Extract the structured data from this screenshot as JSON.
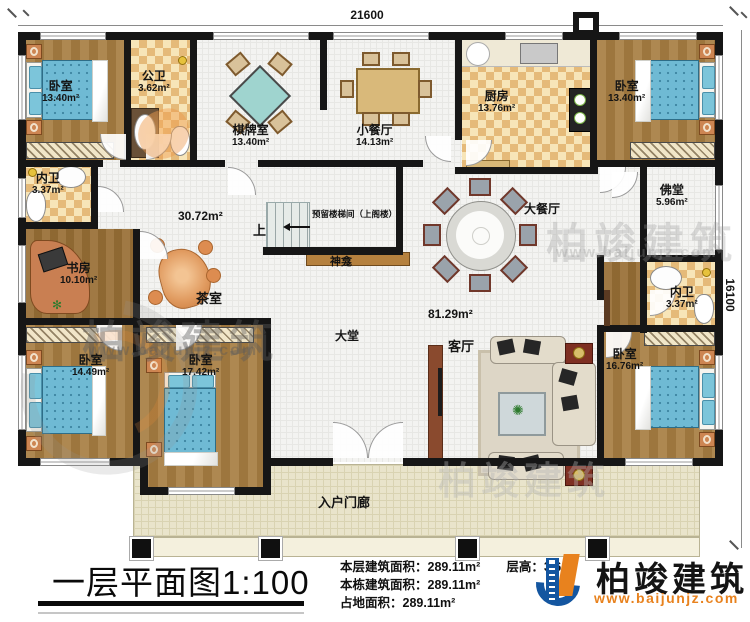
{
  "plan": {
    "dim_top": "21600",
    "dim_right": "16100",
    "stair_note": "预留楼梯间（上阁楼）",
    "stair_up": "上",
    "shrine": "神龛",
    "rooms": {
      "bedroom_tl": {
        "name": "卧室",
        "area": "13.40m²"
      },
      "public_bath": {
        "name": "公卫",
        "area": "3.62m²"
      },
      "chess_room": {
        "name": "棋牌室",
        "area": "13.40m²"
      },
      "small_dining": {
        "name": "小餐厅",
        "area": "14.13m²"
      },
      "kitchen": {
        "name": "厨房",
        "area": "13.76m²"
      },
      "bedroom_tr": {
        "name": "卧室",
        "area": "13.40m²"
      },
      "inner_bath_left": {
        "name": "内卫",
        "area": "3.37m²"
      },
      "study": {
        "name": "书房",
        "area": "10.10m²"
      },
      "tea_room": {
        "name": "茶室",
        "area": "30.72m²"
      },
      "grand_dining": {
        "name": "大餐厅"
      },
      "buddha_hall": {
        "name": "佛堂",
        "area": "5.96m²"
      },
      "inner_bath_right": {
        "name": "内卫",
        "area": "3.37m²"
      },
      "bedroom_bl": {
        "name": "卧室",
        "area": "14.49m²"
      },
      "bedroom_bm": {
        "name": "卧室",
        "area": "17.42m²"
      },
      "hall": {
        "name": "大堂",
        "area": "81.29m²"
      },
      "living_room": {
        "name": "客厅"
      },
      "bedroom_br": {
        "name": "卧室",
        "area": "16.76m²"
      },
      "porch": {
        "name": "入户门廊"
      }
    }
  },
  "footer": {
    "title": "一层平面图1:100",
    "floor_area_label": "本层建筑面积：",
    "floor_area": "289.11m²",
    "building_area_label": "本栋建筑面积：",
    "building_area": "289.11m²",
    "site_area_label": "占地面积：",
    "site_area": "289.11m²",
    "storey_height_label": "层高：",
    "storey_height": "3.6m"
  },
  "brand": {
    "name": "柏竣建筑",
    "website": "www.baijunjz.com"
  },
  "watermark": {
    "text": "柏竣建筑",
    "website": "www.baijunjz.com"
  }
}
